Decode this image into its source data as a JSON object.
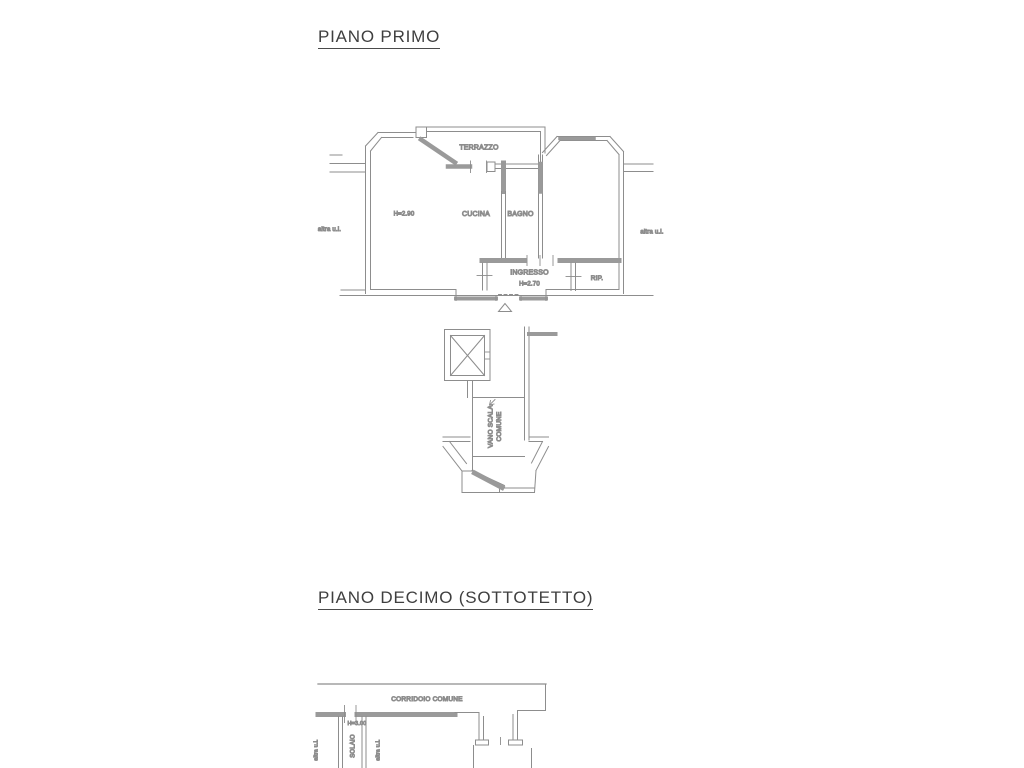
{
  "document": {
    "background": "#ffffff"
  },
  "plan1": {
    "title": "PIANO PRIMO",
    "labels": {
      "terrazzo": "TERRAZZO",
      "room_height": "H=2.90",
      "cucina": "CUCINA",
      "bagno": "BAGNO",
      "ingresso": "INGRESSO",
      "ingresso_height": "H=2.70",
      "rip": "RIP.",
      "altra_ui_left": "altra u.i.",
      "altra_ui_right": "altra u.i."
    },
    "stairwell": {
      "line1": "VANO SCALA",
      "line2": "COMUNE"
    }
  },
  "plan2": {
    "title": "PIANO DECIMO (SOTTOTETTO)",
    "labels": {
      "corridoio": "CORRIDOIO COMUNE",
      "solaio": "SOLAIO",
      "solaio_height": "H=3.00",
      "altra_ui_left": "altra u.i.",
      "altra_ui_right": "altra u.i."
    }
  },
  "colors": {
    "line": "#8d8d8d",
    "wall_fill": "#9a9a9a",
    "label_text": "#7b7b7b",
    "title_text": "#3f3f3f"
  }
}
